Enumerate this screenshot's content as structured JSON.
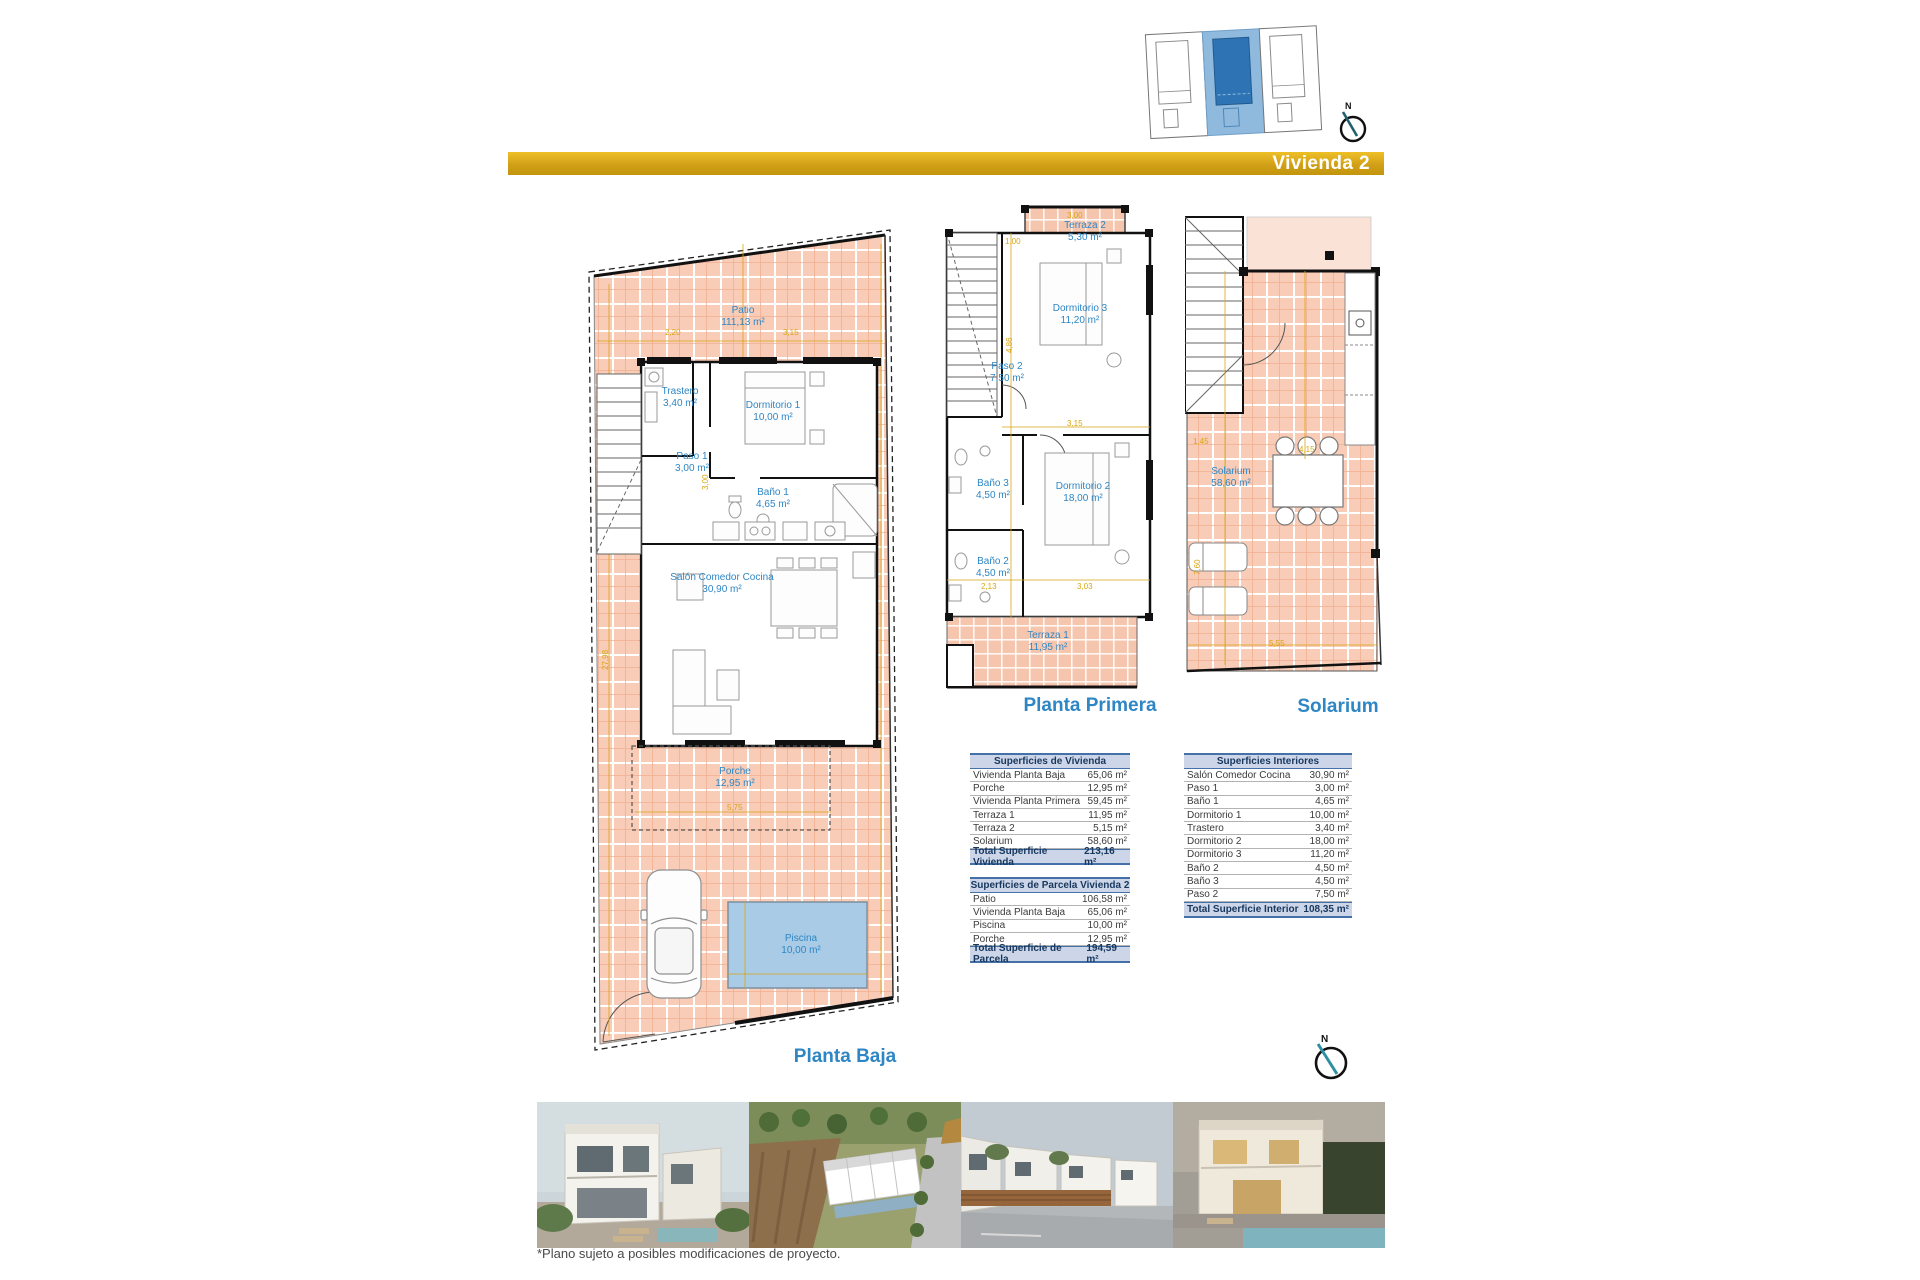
{
  "banner": {
    "title": "Vivienda 2"
  },
  "compass": {
    "north": "N"
  },
  "colors": {
    "brand_gold": "#D2A018",
    "label_blue": "#2E86C5",
    "plan_fill": "#F8CCB6",
    "pool_blue": "#A9CBE5"
  },
  "plans": {
    "planta_baja": {
      "label": "Planta Baja",
      "rooms": [
        {
          "name": "Patio",
          "area": "111,13 m²"
        },
        {
          "name": "Trastero",
          "area": "3,40 m²"
        },
        {
          "name": "Dormitorio 1",
          "area": "10,00 m²"
        },
        {
          "name": "Paso 1",
          "area": "3,00 m²"
        },
        {
          "name": "Baño 1",
          "area": "4,65 m²"
        },
        {
          "name": "Salón Comedor Cocina",
          "area": "30,90 m²"
        },
        {
          "name": "Porche",
          "area": "12,95 m²"
        },
        {
          "name": "Piscina",
          "area": "10,00 m²"
        }
      ],
      "dims": [
        "2,20",
        "3,15",
        "5,75",
        "3,00",
        "27,98"
      ]
    },
    "planta_primera": {
      "label": "Planta Primera",
      "rooms": [
        {
          "name": "Terraza 2",
          "area": "5,30 m²"
        },
        {
          "name": "Dormitorio 3",
          "area": "11,20 m²"
        },
        {
          "name": "Paso 2",
          "area": "7,50 m²"
        },
        {
          "name": "Baño 3",
          "area": "4,50 m²"
        },
        {
          "name": "Dormitorio 2",
          "area": "18,00 m²"
        },
        {
          "name": "Baño 2",
          "area": "4,50 m²"
        },
        {
          "name": "Terraza 1",
          "area": "11,95 m²"
        }
      ],
      "dims": [
        "3,00",
        "1,00",
        "4,86",
        "3,15",
        "2,13",
        "3,03"
      ]
    },
    "solarium": {
      "label": "Solarium",
      "rooms": [
        {
          "name": "Solarium",
          "area": "58,60 m²"
        }
      ],
      "dims": [
        "4,15",
        "7,60",
        "5,55",
        "1,45"
      ]
    }
  },
  "tables": {
    "vivienda": {
      "title": "Superficies de Vivienda",
      "rows": [
        {
          "label": "Vivienda Planta Baja",
          "value": "65,06 m²"
        },
        {
          "label": "Porche",
          "value": "12,95 m²"
        },
        {
          "label": "Vivienda Planta Primera",
          "value": "59,45 m²"
        },
        {
          "label": "Terraza 1",
          "value": "11,95 m²"
        },
        {
          "label": "Terraza 2",
          "value": "5,15 m²"
        },
        {
          "label": "Solarium",
          "value": "58,60 m²"
        }
      ],
      "total": {
        "label": "Total Superficie Vivienda",
        "value": "213,16 m²"
      }
    },
    "parcela": {
      "title": "Superficies de Parcela Vivienda 2",
      "rows": [
        {
          "label": "Patio",
          "value": "106,58 m²"
        },
        {
          "label": "Vivienda Planta Baja",
          "value": "65,06 m²"
        },
        {
          "label": "Piscina",
          "value": "10,00 m²"
        },
        {
          "label": "Porche",
          "value": "12,95 m²"
        }
      ],
      "total": {
        "label": "Total Superficie de Parcela",
        "value": "194,59 m²"
      }
    },
    "interiores": {
      "title": "Superficies Interiores",
      "rows": [
        {
          "label": "Salón Comedor Cocina",
          "value": "30,90 m²"
        },
        {
          "label": "Paso 1",
          "value": "3,00 m²"
        },
        {
          "label": "Baño 1",
          "value": "4,65 m²"
        },
        {
          "label": "Dormitorio 1",
          "value": "10,00 m²"
        },
        {
          "label": "Trastero",
          "value": "3,40 m²"
        },
        {
          "label": "Dormitorio 2",
          "value": "18,00 m²"
        },
        {
          "label": "Dormitorio 3",
          "value": "11,20 m²"
        },
        {
          "label": "Baño 2",
          "value": "4,50 m²"
        },
        {
          "label": "Baño 3",
          "value": "4,50 m²"
        },
        {
          "label": "Paso 2",
          "value": "7,50 m²"
        }
      ],
      "total": {
        "label": "Total Superficie Interior",
        "value": "108,35 m²"
      }
    }
  },
  "footnote": "*Plano sujeto a posibles modificaciones de proyecto."
}
